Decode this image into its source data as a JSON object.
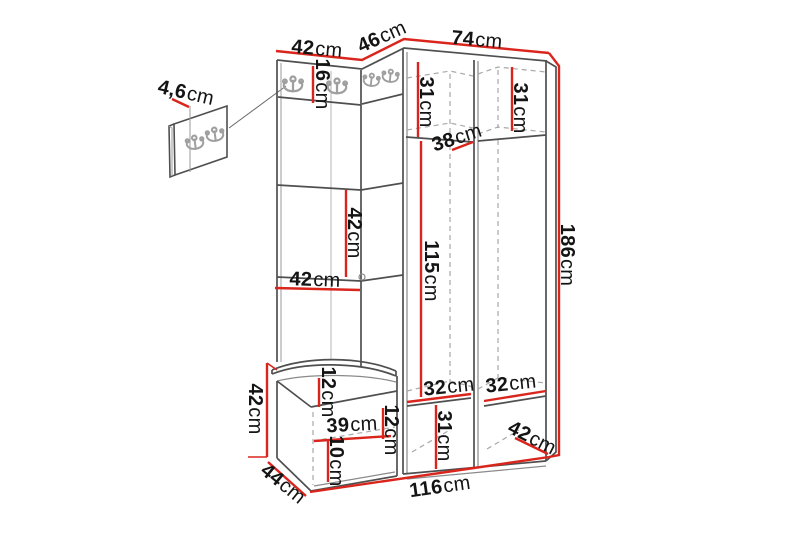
{
  "figure": {
    "type": "furniture-dimension-diagram",
    "subject": "hallway set: wall hook panel, corner coat rack with upholstered panels, wardrobe and shoe bench",
    "colors": {
      "dimension_line": "#da251d",
      "outline": "#4f4f4f",
      "dashed_line": "#a8a8a8",
      "hook_gray": "#9f9f9f",
      "text": "#141414",
      "background": "#ffffff"
    }
  },
  "dimensions": {
    "wall_panel_depth": {
      "num": "4,6",
      "unit": "cm"
    },
    "top_left_width": {
      "num": "42",
      "unit": "cm"
    },
    "top_corner_width": {
      "num": "46",
      "unit": "cm"
    },
    "top_right_width": {
      "num": "74",
      "unit": "cm"
    },
    "hook_rail_height": {
      "num": "16",
      "unit": "cm"
    },
    "left_door_width": {
      "num": "31",
      "unit": "cm"
    },
    "right_door_width": {
      "num": "31",
      "unit": "cm"
    },
    "top_shelf_depth": {
      "num": "38",
      "unit": "cm"
    },
    "total_height": {
      "num": "186",
      "unit": "cm"
    },
    "panel_height": {
      "num": "42",
      "unit": "cm"
    },
    "panel_width": {
      "num": "42",
      "unit": "cm"
    },
    "hanging_height": {
      "num": "115",
      "unit": "cm"
    },
    "left_shelf_width": {
      "num": "32",
      "unit": "cm"
    },
    "right_shelf_width": {
      "num": "32",
      "unit": "cm"
    },
    "bottom_section_height": {
      "num": "31",
      "unit": "cm"
    },
    "base_depth": {
      "num": "42",
      "unit": "cm"
    },
    "bench_height": {
      "num": "42",
      "unit": "cm"
    },
    "bench_top_height": {
      "num": "12",
      "unit": "cm"
    },
    "bench_inner_width": {
      "num": "39",
      "unit": "cm"
    },
    "bench_inner_height": {
      "num": "12",
      "unit": "cm"
    },
    "bench_bottom_height": {
      "num": "10",
      "unit": "cm"
    },
    "bench_depth": {
      "num": "44",
      "unit": "cm"
    },
    "total_width": {
      "num": "116",
      "unit": "cm"
    }
  }
}
